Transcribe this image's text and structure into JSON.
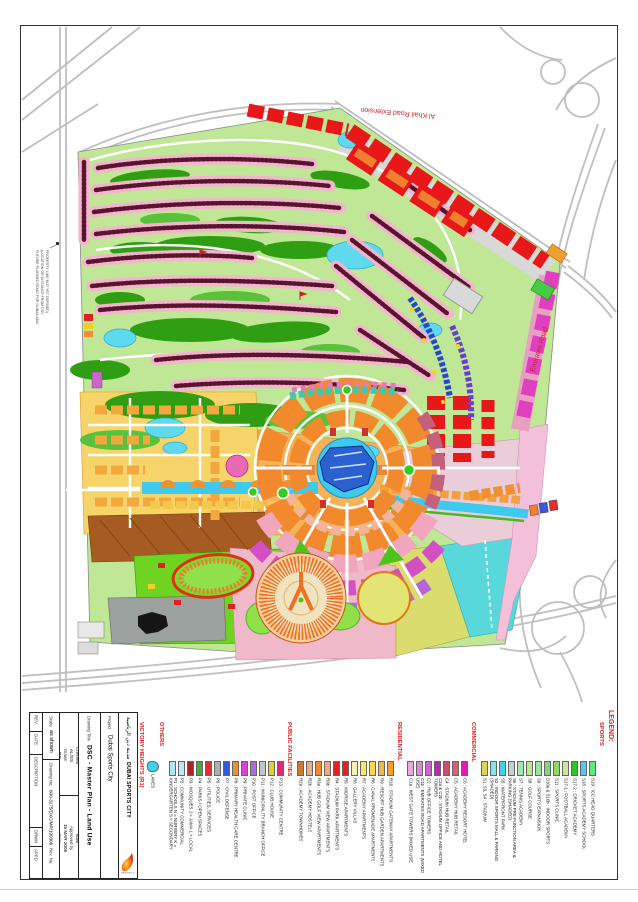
{
  "accent": {
    "legend_red": "#e01818",
    "road_label_red": "#cc2222"
  },
  "map_labels": {
    "al_khail": "Al Khail Road Extension",
    "emirates": "Emirates Road",
    "left_note": [
      "FUTURE PLANNED ROAD FOR DUBAILAND",
      "(LOCATION OR DISTANCE FROM DSC",
      "PROPERTY LINE NOT YET DEFINED)"
    ]
  },
  "legend": {
    "title": "LEGEND:",
    "sections": [
      {
        "name": "SPORTS",
        "items": [
          {
            "label": "S1, S3, S4 : STADIUM",
            "color": "#ddd45e"
          },
          {
            "label": "S2 : INDOOR SPORTS MALL & PARKING (SHADED)",
            "color": "#7de9ef"
          },
          {
            "label": "S5 : WATERFRONT PARK",
            "color": "#44d4e8"
          },
          {
            "label": "S6 : STADIUM PRE-FUNCTION AREA & PARKING (SHADED)",
            "color": "#c9cfce"
          },
          {
            "label": "S7 : TENNIS ACADEMY",
            "color": "#a5e6ad"
          },
          {
            "label": "S8 : GOLF COURSE",
            "color": "#b9e88d"
          },
          {
            "label": "S9 : SPORTS EXPANSION",
            "color": "#9de49d"
          },
          {
            "label": "S10a & S10b : INDOOR SPORTS",
            "color": "#7ed87e"
          },
          {
            "label": "S11 : SPORTS CLINIC",
            "color": "#8fd96b"
          },
          {
            "label": "S17-1 : FOOTBALL ACADEMY",
            "color": "#cfe98e"
          },
          {
            "label": "S17-2 : CRICKET ACADEMY",
            "color": "#2ec42e"
          },
          {
            "label": "S18 : SPORTS ACADEMY SCHOOL",
            "color": "#55c6f0"
          },
          {
            "label": "S19 : ICC HEAD QUARTERS",
            "color": "#62e87a"
          }
        ]
      },
      {
        "name": "COMMERCIAL",
        "items": [
          {
            "label": "C1a : WEST GATE TOWERS (MIXED USE)",
            "color": "#e8a8d8"
          },
          {
            "label": "C1b : EMIRATES ROAD APARTMENTS (MIXED USE)",
            "color": "#d88ad8"
          },
          {
            "label": "C2 : HUB OFFICE TOWERS",
            "color": "#cc66cc"
          },
          {
            "label": "C2a & C2b : STADIUM OFFICE AND HOTEL TOWERS",
            "color": "#c023b8"
          },
          {
            "label": "C4 : STADIUM HUB RETAIL",
            "color": "#c8506e"
          },
          {
            "label": "C5 : ACADEMY HUB RETAIL",
            "color": "#d4607c"
          },
          {
            "label": "C6 : ACADEMY RESORT HOTEL",
            "color": "#e01cb0"
          }
        ]
      },
      {
        "name": "RESIDENTIAL",
        "items": [
          {
            "label": "R2a : ACADEMY TOWNHOMES",
            "color": "#cf7a33"
          },
          {
            "label": "R2b : ACADEMY HOSTELS",
            "color": "#f2a988"
          },
          {
            "label": "R3a : HUB GOLF VIEW APARTMENTS",
            "color": "#f28a2d"
          },
          {
            "label": "R3b : STADIUM VIEW APARTMENTS",
            "color": "#f2a988"
          },
          {
            "label": "R4 : STADIUM PARK APARTMENTS",
            "color": "#e82020"
          },
          {
            "label": "R5 : MIDRISE APARTMENTS",
            "color": "#e82020"
          },
          {
            "label": "R6 : GALLERY VILLAS",
            "color": "#f7f2b4"
          },
          {
            "label": "R7 : ACADEMY APARTMENTS",
            "color": "#f7e75a"
          },
          {
            "label": "R8 : CANAL PROMENADE APARTMENTS",
            "color": "#f7d84a"
          },
          {
            "label": "R9 : RESORT HUB GARDEN APARTMENTS",
            "color": "#f2b84a"
          },
          {
            "label": "R10 : STADIUM GATEWAY APARTMENTS",
            "color": "#f2a030"
          }
        ]
      },
      {
        "name": "PUBLIC FACILITIES",
        "items": [
          {
            "label": "P1 : SCHOOLS  N = NURSERY  K = KINDERGARTEN  S = SECONDARY",
            "color": "#aae8f2"
          },
          {
            "label": "P2 : COMMUNITY COMMERCIAL",
            "color": "#c2e6f5"
          },
          {
            "label": "P3 : MOSQUES  J = JAMA  L = LOCAL",
            "color": "#aa2525"
          },
          {
            "label": "P4 : PARKS / OPEN SPACES",
            "color": "#3fae3f"
          },
          {
            "label": "P5 : UTILITIES, SERVICES",
            "color": "#e03030"
          },
          {
            "label": "P6 : POLICE",
            "color": "#a8b0b0"
          },
          {
            "label": "P7 : CIVIL DEFENSE",
            "color": "#3858e0"
          },
          {
            "label": "P8 : PRIMARY HEALTH CARE CENTRE",
            "color": "#f29030"
          },
          {
            "label": "P9 : PRIVATE CLINIC",
            "color": "#d743d7"
          },
          {
            "label": "P10 : POST OFFICE",
            "color": "#a86ee0"
          },
          {
            "label": "P11 : MUNICIPALITY BRANCH OFFICE",
            "color": "#c6c6c6"
          },
          {
            "label": "P12 : CLUB HOUSE",
            "color": "#d8d433"
          },
          {
            "label": "P13 : COMMUNITY CENTRE",
            "color": "#e02878"
          }
        ]
      },
      {
        "name": "OTHERS",
        "blob": true,
        "items": [
          {
            "label": "LAKES",
            "color": "#3fd2f2"
          }
        ]
      },
      {
        "name": "VICTORY HEIGHTS (R1)",
        "grid": true,
        "items": [
          {
            "label": "VILLA TYPE A",
            "color": "#f2cda0"
          },
          {
            "label": "TOWN HOUSES",
            "color": "#e8a55f"
          },
          {
            "label": "VILLA TYPE B",
            "color": "#f5f0b8"
          },
          {
            "label": "VILLA TYPE C",
            "color": "#f2e049"
          }
        ]
      }
    ]
  },
  "title_block": {
    "revision_headers": [
      "REV.",
      "DATE",
      "DESCRIPTION",
      "DRWN",
      "APPD"
    ],
    "scale_label": "Scale",
    "scale_value": "as shown",
    "drawing_no_label": "Drawing No.",
    "drawing_no_value": "600-3175/DXC/MP/190306",
    "rev_no_label": "Rev. No.",
    "designed_label": "Designed",
    "designed_value": "RG",
    "drawn_label": "Drawn",
    "drawn_value": "AL/SS",
    "checked_label": "Checked",
    "checked_value": "MS/AM",
    "date_label": "Date",
    "date_value": "15 MAR 2006",
    "approved_label": "Approved by",
    "approved_value": "BJM",
    "drawing_title_label": "Drawing Title",
    "drawing_title_value": "DSC - Master Plan - Land Use",
    "project_label": "Project",
    "project_value": "Dubai Sports City",
    "brand_arabic": "مدينة دبي الرياضية",
    "brand_english": "DUBAI SPORTS CITY",
    "logo_text": "DUBAI SPORTS CITY"
  }
}
